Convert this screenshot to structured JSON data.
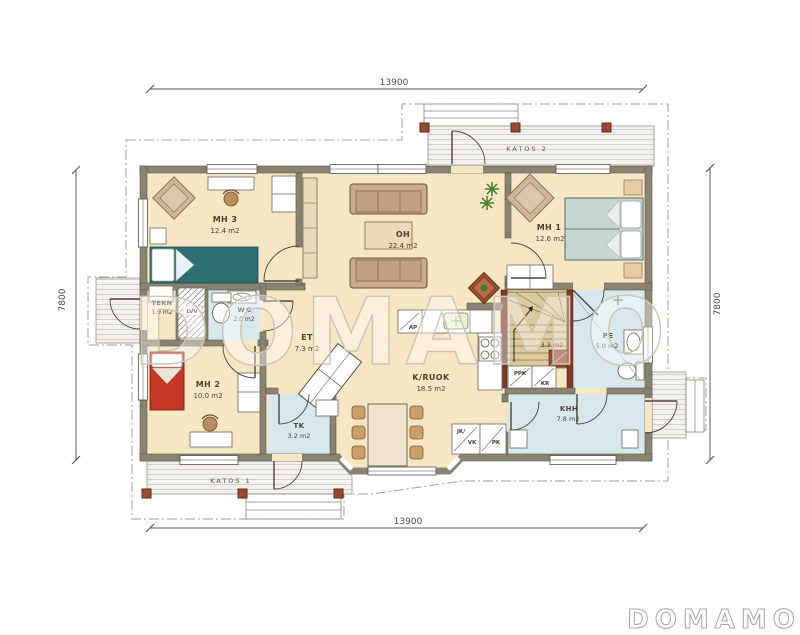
{
  "meta": {
    "watermark": "DOMAMO",
    "logo": "DOMAMO"
  },
  "dimensions": {
    "top": "13900",
    "bottom": "13900",
    "left": "7800",
    "right": "7800"
  },
  "porches": {
    "katos1": "KATOS 1",
    "katos2": "KATOS 2"
  },
  "rooms": {
    "mh3": {
      "name": "MH 3",
      "area": "12.4 m2"
    },
    "oh": {
      "name": "OH",
      "area": "22.4 m2"
    },
    "mh1": {
      "name": "MH 1",
      "area": "12.6 m2"
    },
    "tekn": {
      "name": "TEKN",
      "area": "1.9 m2"
    },
    "wc": {
      "name": "WC",
      "area": "2.0 m2"
    },
    "et": {
      "name": "ET",
      "area": "7.3 m2"
    },
    "mh2": {
      "name": "MH 2",
      "area": "10.0 m2"
    },
    "kruok": {
      "name": "K/RUOK",
      "area": "18.5 m2"
    },
    "tk": {
      "name": "TK",
      "area": "3.2 m2"
    },
    "khh": {
      "name": "KHH",
      "area": "7.8 m2"
    },
    "pe": {
      "name": "PE",
      "area": "5.0 m2"
    },
    "stairs": {
      "area": "3.3 m2"
    }
  },
  "appliances": {
    "lvv": "LVV",
    "ap": "AP",
    "ppk": "PPK",
    "kr": "KR",
    "jk": "JK/",
    "vk": "VK",
    "pk": "PK"
  },
  "colors": {
    "floor": "#f7e6c3",
    "wall": "#8b8372",
    "wet_floor": "#d6e8ec",
    "stair_wood": "#dcc99f",
    "bed_teal": "#2e6f74",
    "bed_pale": "#c6d8d2",
    "bed_red": "#c23a26",
    "sofa": "#c9aa8d",
    "accent_wood": "#9a4a30",
    "watermark": "#ccc5b5"
  }
}
